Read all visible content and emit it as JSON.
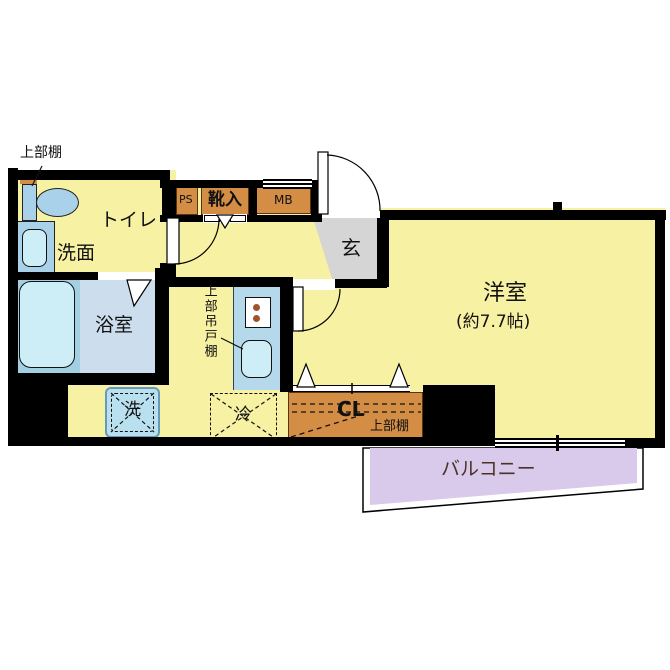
{
  "labels": {
    "upper_shelf_toilet": "上部棚",
    "toilet": "トイレ",
    "washroom": "洗面",
    "bathroom": "浴室",
    "ps": "PS",
    "shoe_cabinet": "靴入",
    "meter_box": "MB",
    "entrance": "玄",
    "western_room": "洋室",
    "western_room_size": "(約7.7帖)",
    "upper_hanging_cabinet": "上部吊戸棚",
    "washer": "洗",
    "fridge": "冷",
    "closet": "CL",
    "upper_shelf_closet": "上部棚",
    "balcony": "バルコニー"
  },
  "colors": {
    "floor": "#f6f1a3",
    "wall": "#000000",
    "bath_floor": "#ccdeed",
    "tub_zone": "#a3cfe3",
    "fixture_blue": "#a9d2ea",
    "fixture_inner": "#cdeef6",
    "counter": "#b5d9ea",
    "storage_orange": "#d38d45",
    "entrance_gray": "#d5d5d5",
    "balcony_purple": "#d9c9ea",
    "washer_blue": "#b9e0ef"
  }
}
